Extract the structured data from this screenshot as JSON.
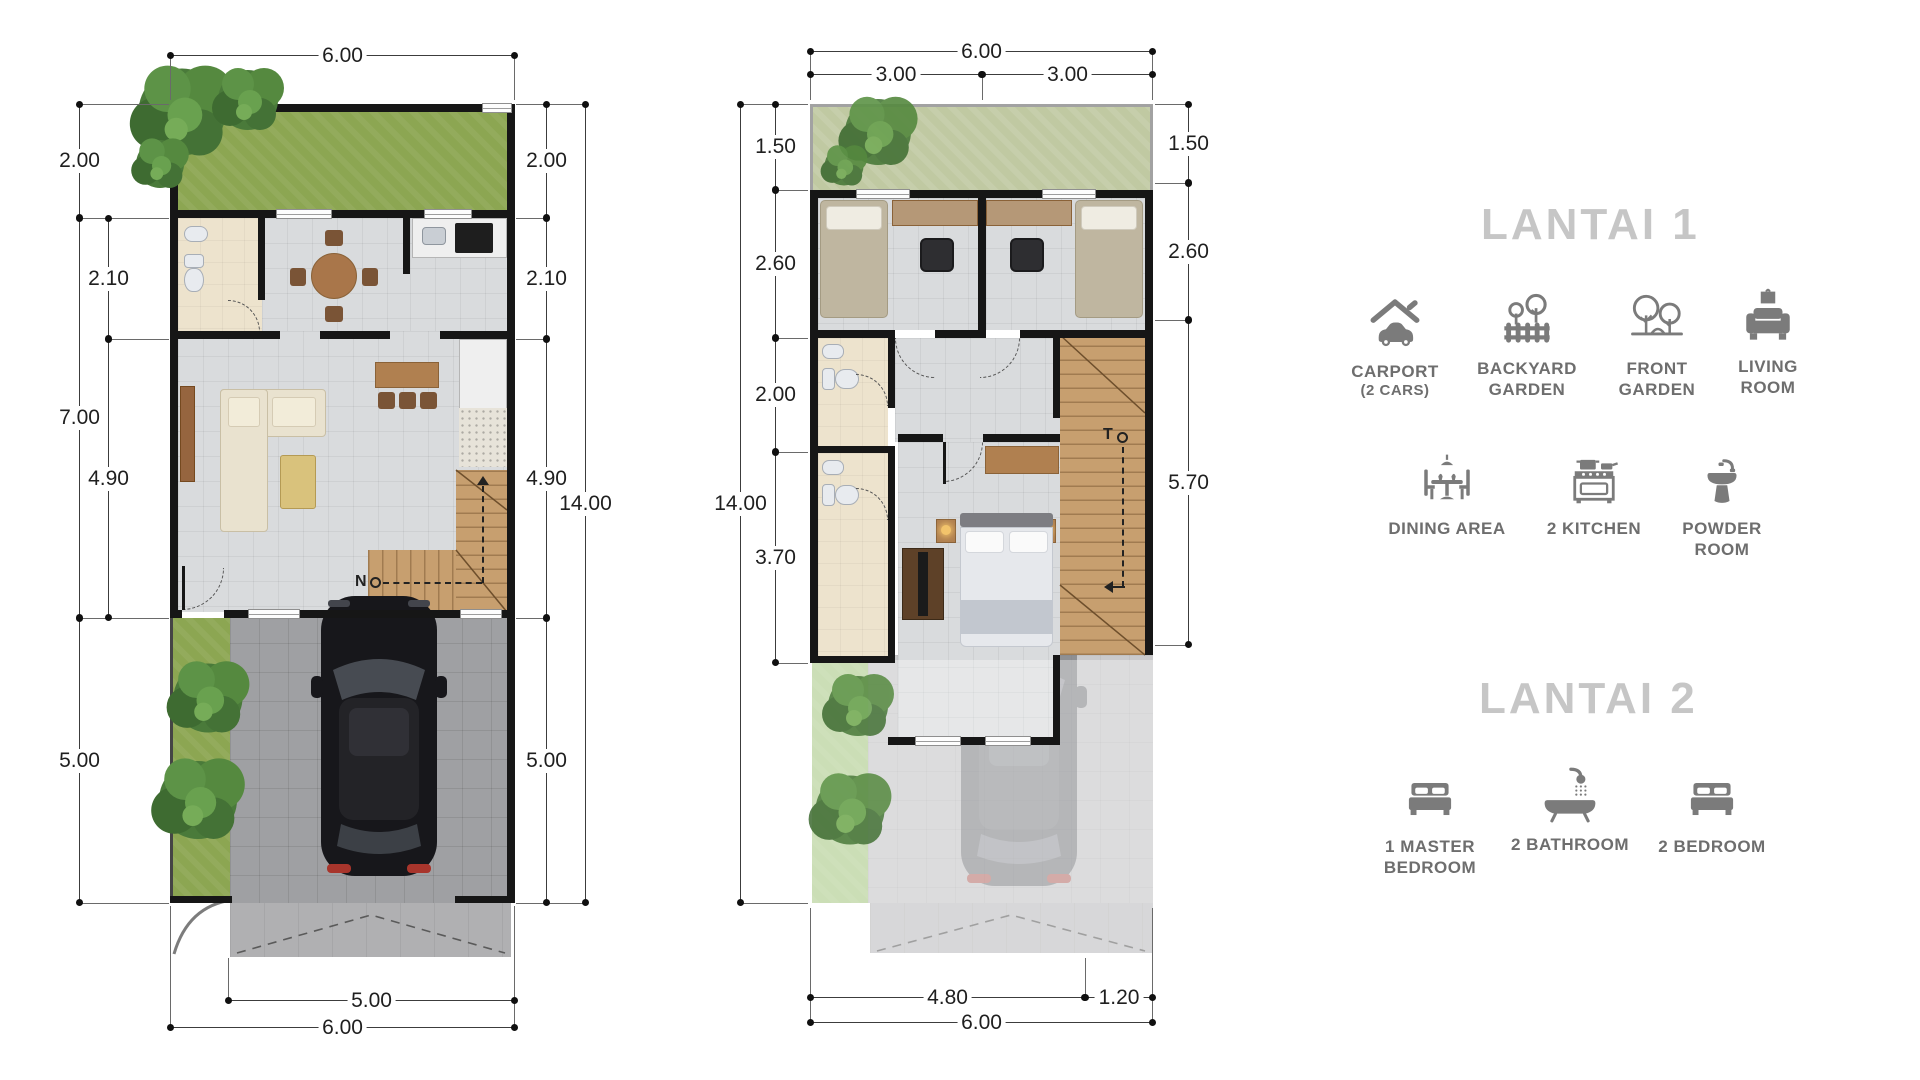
{
  "plan1": {
    "width_top": "6.00",
    "left_outer": [
      "2.00",
      "7.00",
      "5.00"
    ],
    "left_inner": [
      "2.10",
      "4.90"
    ],
    "right_inner": [
      "2.00",
      "2.10",
      "4.90",
      "5.00"
    ],
    "right_outer": [
      "14.00"
    ],
    "bottom": [
      "5.00",
      "6.00"
    ],
    "stair_up_label": "N"
  },
  "plan2": {
    "width_top": "6.00",
    "top_halves": [
      "3.00",
      "3.00"
    ],
    "left_inner": [
      "1.50",
      "2.60",
      "2.00",
      "3.70"
    ],
    "left_outer": [
      "14.00"
    ],
    "right_inner": [
      "1.50",
      "2.60",
      "5.70"
    ],
    "bottom": [
      "4.80",
      "1.20",
      "6.00"
    ],
    "stair_down_label": "T"
  },
  "legend": {
    "floor1_title": "LANTAI 1",
    "floor2_title": "LANTAI 2",
    "items": {
      "carport": {
        "label": "CARPORT",
        "sub": "(2 CARS)"
      },
      "backyard": {
        "label": "BACKYARD GARDEN"
      },
      "front": {
        "label": "FRONT GARDEN"
      },
      "living": {
        "label": "LIVING ROOM"
      },
      "dining": {
        "label": "DINING AREA"
      },
      "kitchen": {
        "label": "2 KITCHEN"
      },
      "powder": {
        "label": "POWDER ROOM"
      },
      "master": {
        "label": "1 MASTER BEDROOM"
      },
      "bathroom": {
        "label": "2 BATHROOM"
      },
      "bedroom": {
        "label": "2 BEDROOM"
      }
    }
  },
  "colors": {
    "wall": "#161616",
    "grass": "#8ca652",
    "sage_garden": "#c0c9a2",
    "wood_stairs": "#c79f6f",
    "icon_gray": "#7b7b7b",
    "title_gray": "#c6c6c6",
    "tile": "#d9dbdd",
    "pavement": "#9fa0a3"
  }
}
